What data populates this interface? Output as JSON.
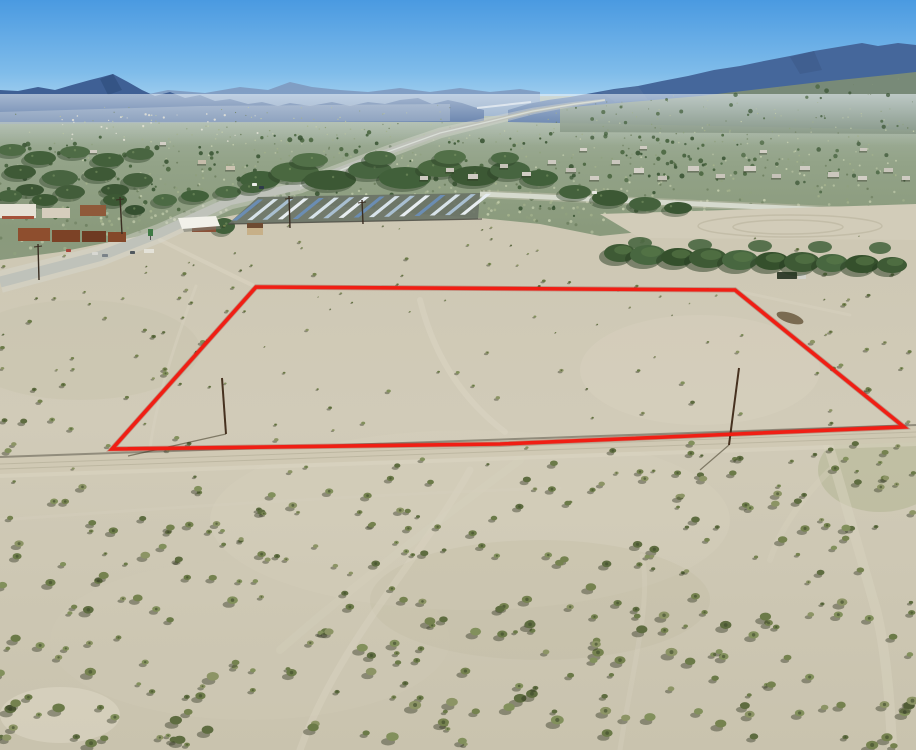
{
  "canvas": {
    "w": 916,
    "h": 750
  },
  "seed": 20240117,
  "sky": {
    "stops": [
      "#4A9AE1",
      "#7FBCEA",
      "#C9E4F5"
    ],
    "height": 132
  },
  "haze": {
    "color": "#EAF2F8",
    "y": 94,
    "h": 52
  },
  "valley": {
    "top": 96,
    "bottom": 286,
    "stops": [
      "#A8B6A8",
      "#93A388",
      "#8A9A7C",
      "#8C9B7F"
    ],
    "speckle": {
      "count": 780,
      "colors": [
        "#B7C2A2",
        "#A3B18C",
        "#8FA07E",
        "#C2CCAC",
        "#6E8060"
      ]
    },
    "tree_dots": {
      "count": 180,
      "colors": [
        "#3F5C37",
        "#46633C",
        "#365130"
      ]
    },
    "right_dots": {
      "count": 60
    },
    "far_specks": {
      "count": 30,
      "color": "#E8E6DA"
    },
    "streak": {
      "x1": 477,
      "y1": 108,
      "x2": 531,
      "y2": 102,
      "color": "#E9EFF4"
    },
    "right_slope": {
      "points": "560,108 700,96 820,82 916,72 916,134 560,132",
      "color": "#7B8C76"
    },
    "foothill": {
      "points": "0,112 200,106 450,104 450,121 0,124",
      "color": "#91A4BC"
    }
  },
  "mountains": {
    "back": {
      "color": "#7F9CC2",
      "points": "130,98 168,90 205,93 240,87 268,90 290,82 312,87 340,90 368,92 400,88 430,92 460,88 490,92 520,89 540,92 540,116 130,116"
    },
    "left": {
      "color": "#3F6095",
      "points": "0,90 18,91 38,87 55,90 72,85 90,80 102,77 113,74 128,82 142,90 155,96 170,92 185,98 200,95 215,101 230,99 248,104 262,102 278,106 290,103 310,106 332,102 350,106 368,102 385,104 400,100 418,98 432,104 448,100 462,103 474,107 484,110 484,122 0,122"
    },
    "right": {
      "color": "#45679B",
      "points": "508,110 528,104 548,100 570,97 592,93 614,89 638,86 662,81 688,76 714,70 740,66 764,61 790,56 814,51 838,47 862,43 878,46 898,43 916,45 916,130 508,122"
    },
    "facets": [
      {
        "color": "#30507F",
        "points": "100,79 113,74 122,90 108,95",
        "op": 0.7
      },
      {
        "color": "#3D5A88",
        "points": "790,57 814,51 822,70 800,74",
        "op": 0.6
      },
      {
        "color": "#54719E",
        "points": "600,92 638,86 648,100 615,102",
        "op": 0.6
      }
    ]
  },
  "fg": {
    "boundary": [
      [
        0,
        260
      ],
      [
        60,
        252
      ],
      [
        140,
        236
      ],
      [
        200,
        222
      ],
      [
        240,
        214
      ],
      [
        300,
        204
      ],
      [
        360,
        208
      ],
      [
        420,
        214
      ],
      [
        480,
        218
      ],
      [
        540,
        224
      ],
      [
        600,
        236
      ],
      [
        660,
        230
      ],
      [
        720,
        230
      ],
      [
        780,
        236
      ],
      [
        850,
        230
      ],
      [
        916,
        222
      ]
    ],
    "stops": [
      "#CDC7B3",
      "#D1CBB8",
      "#C9C3AE"
    ],
    "patches": [
      [
        470,
        520,
        260,
        90,
        "#D8D1BE",
        0.35
      ],
      [
        250,
        640,
        200,
        80,
        "#CFC9B5",
        0.3
      ],
      [
        540,
        600,
        170,
        60,
        "#B9B79D",
        0.22
      ],
      [
        80,
        350,
        120,
        50,
        "#C4C0A9",
        0.3
      ],
      [
        880,
        470,
        62,
        42,
        "#9AA477",
        0.3
      ],
      [
        700,
        370,
        120,
        55,
        "#DAD3C1",
        0.4
      ],
      [
        60,
        715,
        60,
        28,
        "#E0DAC8",
        0.5
      ]
    ],
    "road_band": {
      "points": "0,456 916,424 916,442 0,474",
      "color": "#CFC9B4",
      "edge": "#46443A",
      "shoulder": "#DCD6C3"
    },
    "trails": [
      [
        "M300,750 C340,640 420,560 470,470",
        "#D9D3C0",
        7,
        0.45
      ],
      [
        "M620,750 C632,670 652,600 642,556",
        "#D8D2BF",
        5,
        0.35
      ],
      [
        "M420,300 C430,340 452,392 505,432",
        "#DCD5C3",
        6,
        0.5
      ],
      [
        "M0,520 C200,505 420,492 560,488",
        "#D8D2BF",
        3,
        0.3
      ],
      [
        "M196,286 C180,330 158,390 150,448",
        "#D8D2BF",
        3,
        0.5
      ],
      [
        "M160,240 L256,287 L737,291",
        "#D8D2BF",
        4,
        0.7
      ],
      [
        "M737,291 L850,315",
        "#D8D2BF",
        3,
        0.5
      ],
      [
        "M828,444 C842,490 856,540 876,610 C886,650 890,700 892,748",
        "#D7D1BE",
        10,
        0.55
      ],
      [
        "M830,470 C800,500 780,530 770,560",
        "#D7D1BE",
        6,
        0.35
      ],
      [
        "M520,460 C440,520 360,580 280,650",
        "#D9D3C0",
        8,
        0.25
      ]
    ],
    "shrubs": {
      "count": 560,
      "bodies": [
        "#75824F",
        "#82905C",
        "#6B7A48",
        "#8C9465",
        "#5E6C40"
      ],
      "shadow": "rgba(45,50,30,0.42)",
      "core": "#3E4A2C"
    }
  },
  "parcel": {
    "points": [
      [
        256,
        287
      ],
      [
        735,
        290
      ],
      [
        904,
        427
      ],
      [
        737,
        434
      ],
      [
        500,
        444
      ],
      [
        112,
        449
      ]
    ],
    "color": "#F01E14",
    "under": "#8E0E08",
    "width": 3.6
  },
  "roads": {
    "main": {
      "pts": [
        [
          0,
          282
        ],
        [
          100,
          256
        ],
        [
          160,
          233
        ],
        [
          230,
          201
        ],
        [
          300,
          186
        ],
        [
          390,
          151
        ],
        [
          440,
          133
        ],
        [
          487,
          122
        ],
        [
          533,
          111
        ],
        [
          575,
          104
        ],
        [
          605,
          100
        ]
      ],
      "w0": 11,
      "w1": 1.2,
      "color": "#BFC2BA",
      "shoulder": "#D8D8CE",
      "far_bright": "#E0E5DF"
    },
    "right": {
      "x1": 480,
      "y1": 194,
      "x2": 916,
      "y2": 214,
      "w": 5,
      "color": "#D6DACE",
      "shoulder": "#CFC9B8"
    },
    "pad": {
      "points": "600,214 916,204 916,240 640,238",
      "color": "#D2CCB9",
      "arcs": [
        [
          790,
          226,
          92,
          11
        ],
        [
          788,
          227,
          55,
          7
        ]
      ],
      "arc_color": "#BFB9A4"
    }
  },
  "solar": {
    "base": {
      "points": "228,224 258,197 480,193 478,219",
      "color": "#6A7366"
    },
    "rows": 16,
    "x0": 232,
    "dx": 15.2,
    "y0": 220.5,
    "dy": -0.38,
    "run": 26,
    "rise": -21,
    "wstrip": 5,
    "colors": [
      "#6B8DB3",
      "#D8E3EA",
      "#A9BFD1",
      "#E7EDF1"
    ],
    "fence": {
      "x1": 228,
      "y1": 224,
      "x2": 482,
      "y2": 219,
      "color": "#4A4A42"
    }
  },
  "buildings": {
    "rects": [
      [
        0,
        204,
        36,
        14,
        "#E6E2D6"
      ],
      [
        2,
        216,
        32,
        3,
        "#A4523A"
      ],
      [
        42,
        208,
        28,
        10,
        "#D6CDBD"
      ],
      [
        80,
        205,
        26,
        11,
        "#8F5A3A"
      ],
      [
        18,
        228,
        32,
        13,
        "#8E4E2E"
      ],
      [
        52,
        230,
        28,
        12,
        "#7C4226"
      ],
      [
        82,
        231,
        24,
        11,
        "#6E3A22"
      ],
      [
        108,
        232,
        18,
        10,
        "#84482A"
      ],
      [
        144,
        249,
        10,
        4,
        "#E4E2D8"
      ],
      [
        192,
        222,
        24,
        10,
        "#8A5138"
      ],
      [
        247,
        227,
        16,
        8,
        "#C7B088"
      ],
      [
        247,
        223,
        16,
        5,
        "#6E4B32"
      ]
    ],
    "canopy": {
      "points": "178,218 216,216 220,226 182,229",
      "color": "#F2F1EA"
    },
    "canopy_shadow": {
      "points": "181,223 218,221 221,229 184,232",
      "color": "#7A7A70"
    },
    "sign": {
      "x": 148,
      "y": 229,
      "w": 5,
      "h": 7,
      "color": "#3F7A46"
    }
  },
  "houses": [
    [
      420,
      176,
      8,
      4,
      "#CFCBC2"
    ],
    [
      446,
      168,
      8,
      4,
      "#C9C5BB"
    ],
    [
      468,
      174,
      10,
      5,
      "#CFCBC2"
    ],
    [
      500,
      164,
      8,
      4,
      "#C6C2B8"
    ],
    [
      522,
      172,
      9,
      4,
      "#D2CEC5"
    ],
    [
      548,
      160,
      8,
      4,
      "#CDC9C0"
    ],
    [
      566,
      168,
      10,
      4,
      "#C2BEB4"
    ],
    [
      590,
      176,
      9,
      4,
      "#D0CCC3"
    ],
    [
      612,
      160,
      8,
      4,
      "#CAC6BD"
    ],
    [
      634,
      168,
      10,
      5,
      "#D5D1C8"
    ],
    [
      658,
      176,
      9,
      4,
      "#C5C1B7"
    ],
    [
      688,
      166,
      11,
      5,
      "#CFCBC2"
    ],
    [
      716,
      174,
      9,
      4,
      "#C9C5BB"
    ],
    [
      744,
      166,
      12,
      5,
      "#D2CEC5"
    ],
    [
      772,
      174,
      9,
      4,
      "#C6C2B8"
    ],
    [
      800,
      166,
      10,
      4,
      "#CFCBC2"
    ],
    [
      828,
      172,
      11,
      5,
      "#CBC7BD"
    ],
    [
      858,
      176,
      9,
      4,
      "#D2CEC5"
    ],
    [
      884,
      168,
      9,
      4,
      "#C8C4BA"
    ],
    [
      902,
      176,
      8,
      4,
      "#CFCBC2"
    ],
    [
      226,
      166,
      9,
      4,
      "#CCC3B1"
    ],
    [
      198,
      160,
      8,
      4,
      "#C5BCAA"
    ],
    [
      580,
      148,
      7,
      3,
      "#D6D2C9"
    ],
    [
      640,
      146,
      7,
      3,
      "#CFCBC2"
    ],
    [
      760,
      150,
      7,
      3,
      "#D3CFC6"
    ],
    [
      860,
      148,
      7,
      3,
      "#CBC7BE"
    ],
    [
      90,
      150,
      7,
      3,
      "#CFCBC2"
    ],
    [
      160,
      142,
      6,
      3,
      "#D3CFC6"
    ]
  ],
  "vehicles": [
    [
      252,
      183,
      5,
      3,
      "#EDEDE9"
    ],
    [
      259,
      186,
      5,
      3,
      "#2E3A4A"
    ],
    [
      92,
      252,
      6,
      3,
      "#D8D8D2"
    ],
    [
      102,
      254,
      6,
      3,
      "#7A8288"
    ],
    [
      130,
      251,
      5,
      3,
      "#50585E"
    ],
    [
      66,
      249,
      5,
      3,
      "#A8443A"
    ],
    [
      777,
      272,
      20,
      7,
      "#35402F"
    ],
    [
      798,
      274,
      8,
      5,
      "#D2D2CA"
    ],
    [
      592,
      191,
      5,
      3,
      "#E8E8E2"
    ]
  ],
  "veg": {
    "clusters": [
      [
        12,
        150,
        14,
        6,
        "#4E6B45"
      ],
      [
        40,
        158,
        16,
        7,
        "#43603B"
      ],
      [
        75,
        152,
        15,
        6,
        "#4E6B45"
      ],
      [
        108,
        160,
        16,
        7,
        "#43603B"
      ],
      [
        140,
        154,
        14,
        6,
        "#496541"
      ],
      [
        20,
        172,
        16,
        7,
        "#3E5936"
      ],
      [
        60,
        178,
        18,
        8,
        "#486440"
      ],
      [
        100,
        174,
        16,
        7,
        "#3E5936"
      ],
      [
        138,
        180,
        15,
        7,
        "#445F3C"
      ],
      [
        30,
        190,
        14,
        6,
        "#3A5433"
      ],
      [
        70,
        192,
        15,
        7,
        "#425D3A"
      ],
      [
        115,
        190,
        14,
        6,
        "#3A5433"
      ],
      [
        260,
        180,
        20,
        9,
        "#41603A"
      ],
      [
        295,
        172,
        24,
        10,
        "#4A6840"
      ],
      [
        330,
        180,
        26,
        10,
        "#3C5834"
      ],
      [
        370,
        170,
        22,
        9,
        "#476540"
      ],
      [
        405,
        178,
        26,
        11,
        "#41603A"
      ],
      [
        440,
        168,
        22,
        9,
        "#4A6840"
      ],
      [
        475,
        176,
        24,
        10,
        "#3C5834"
      ],
      [
        510,
        170,
        20,
        9,
        "#476540"
      ],
      [
        540,
        178,
        18,
        8,
        "#41603A"
      ],
      [
        310,
        160,
        18,
        7,
        "#527048"
      ],
      [
        380,
        158,
        16,
        7,
        "#4C6A44"
      ],
      [
        450,
        157,
        16,
        7,
        "#527048"
      ],
      [
        505,
        158,
        14,
        6,
        "#4C6A44"
      ],
      [
        575,
        192,
        16,
        7,
        "#44613C"
      ],
      [
        610,
        198,
        18,
        8,
        "#3C5834"
      ],
      [
        645,
        204,
        16,
        7,
        "#44613C"
      ],
      [
        678,
        208,
        14,
        6,
        "#3A5633"
      ],
      [
        165,
        200,
        12,
        6,
        "#4C6A44"
      ],
      [
        195,
        196,
        14,
        6,
        "#41603A"
      ],
      [
        228,
        192,
        13,
        6,
        "#4C6A44"
      ],
      [
        252,
        188,
        12,
        5,
        "#44613C"
      ],
      [
        224,
        226,
        11,
        8,
        "#41603A"
      ],
      [
        10,
        196,
        12,
        6,
        "#46633E"
      ],
      [
        45,
        200,
        13,
        6,
        "#3C5834"
      ],
      [
        115,
        200,
        12,
        6,
        "#3C5834"
      ],
      [
        135,
        210,
        10,
        5,
        "#355030"
      ]
    ],
    "tamarisk": [
      [
        620,
        253,
        16,
        9
      ],
      [
        648,
        255,
        18,
        10
      ],
      [
        678,
        257,
        17,
        9
      ],
      [
        708,
        258,
        19,
        10
      ],
      [
        740,
        260,
        18,
        10
      ],
      [
        772,
        261,
        17,
        9
      ],
      [
        802,
        262,
        18,
        10
      ],
      [
        832,
        263,
        16,
        9
      ],
      [
        862,
        264,
        17,
        9
      ],
      [
        892,
        265,
        15,
        8
      ]
    ],
    "tam_colors": [
      "#3E5A35",
      "#486740",
      "#35502C"
    ],
    "tam_back": [
      [
        640,
        243,
        12,
        6
      ],
      [
        700,
        245,
        12,
        6
      ],
      [
        760,
        246,
        12,
        6
      ],
      [
        820,
        247,
        12,
        6
      ],
      [
        880,
        248,
        11,
        6
      ]
    ],
    "tam_back_color": "#4A6741",
    "debris": {
      "cx": 790,
      "cy": 318,
      "rx": 14,
      "ry": 5,
      "color": "#6B5B3F"
    }
  },
  "poles": {
    "parcel": [
      [
        222,
        378,
        226,
        434
      ],
      [
        739,
        368,
        729,
        445
      ]
    ],
    "parcel_color": "#46311F",
    "shadows": [
      [
        226,
        434,
        128,
        456
      ],
      [
        729,
        445,
        700,
        470
      ]
    ],
    "shadow_color": "rgba(60,55,35,0.55)",
    "road": [
      [
        38,
        244,
        39,
        280
      ],
      [
        120,
        197,
        122,
        234
      ],
      [
        289,
        196,
        290,
        228
      ],
      [
        362,
        200,
        363,
        224
      ]
    ],
    "road_color": "#3A2E22"
  }
}
